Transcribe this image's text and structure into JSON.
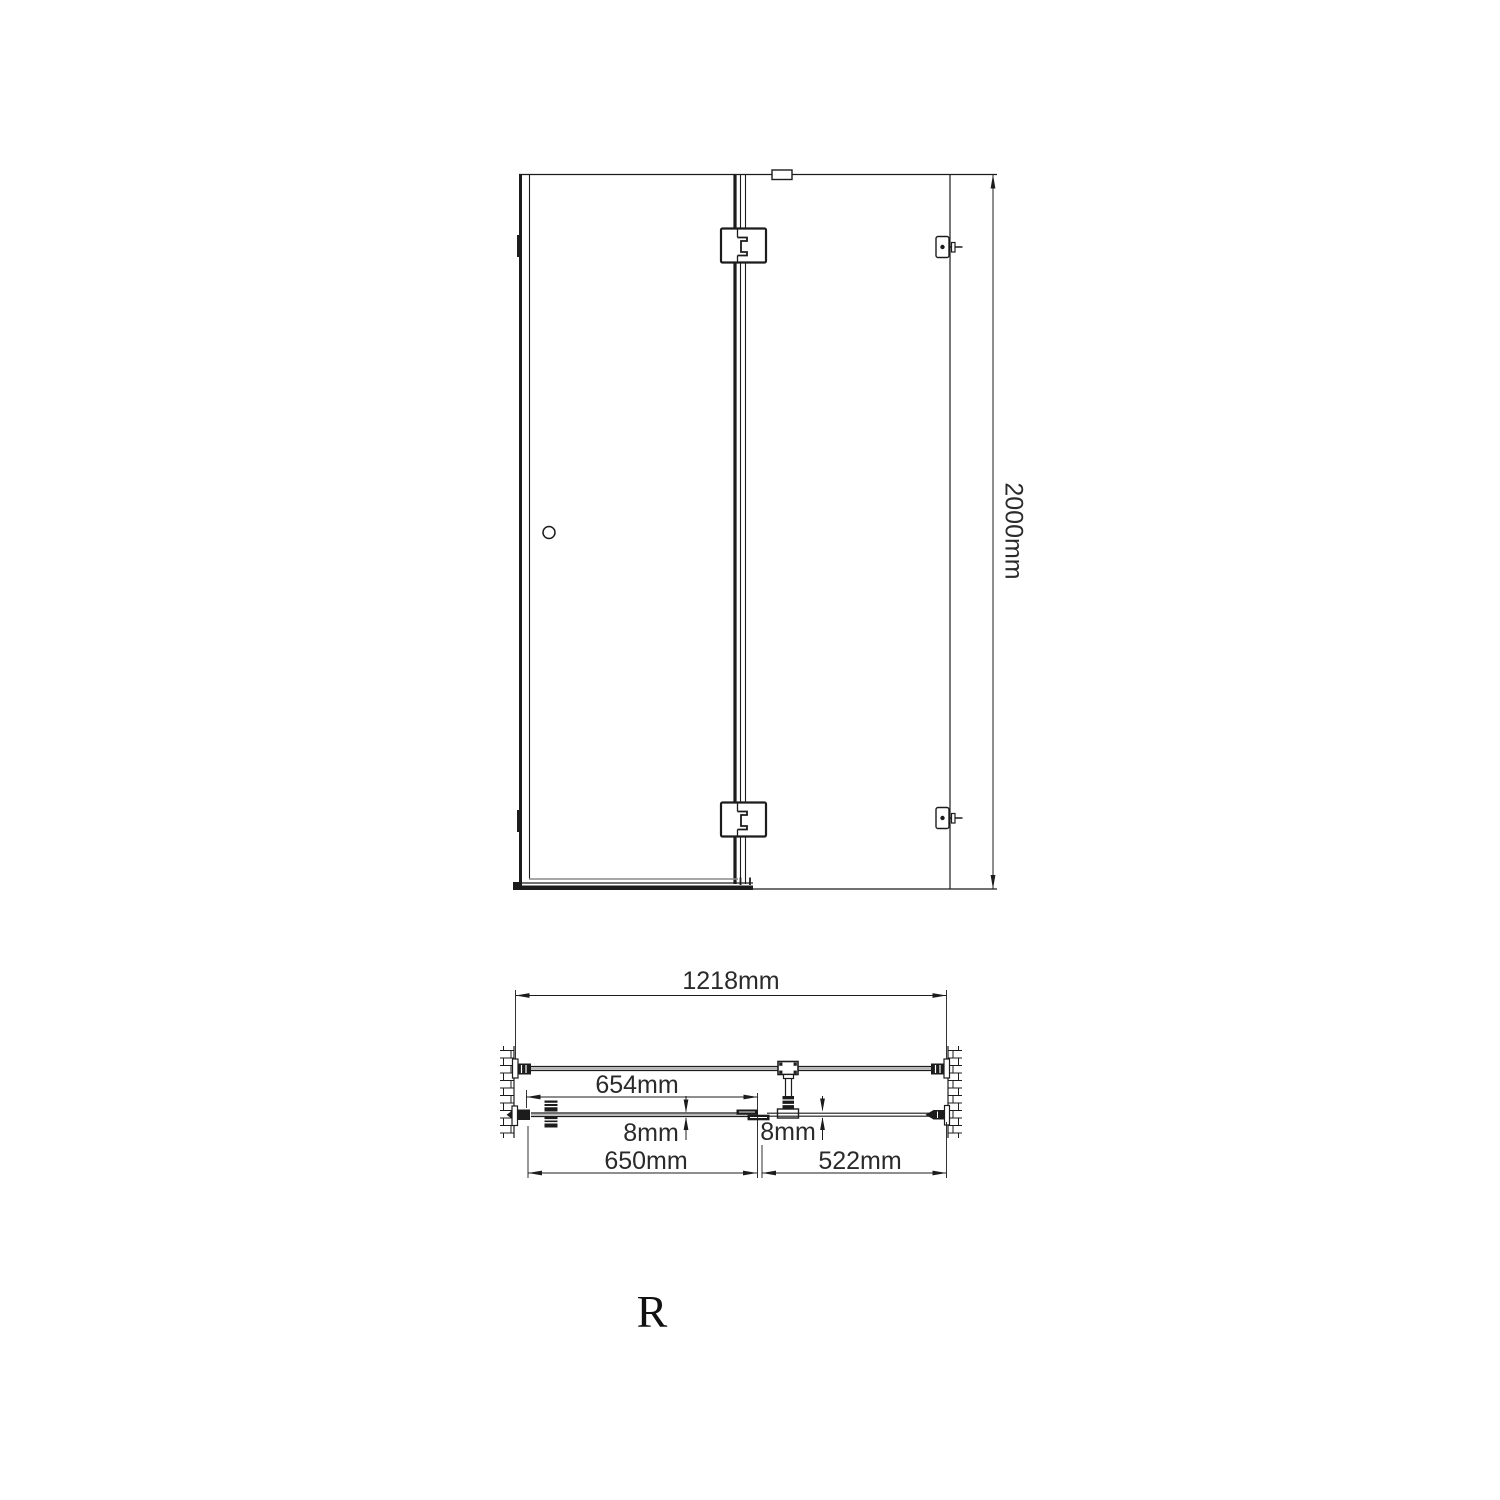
{
  "drawing": {
    "front_elevation": {
      "height_label": "2000mm"
    },
    "plan_view": {
      "overall_width_label": "1218mm",
      "glass_width_label": "654mm",
      "door_glass_thickness_label": "8mm",
      "panel_glass_thickness_label": "8mm",
      "door_width_label": "650mm",
      "side_panel_width_label": "522mm"
    },
    "handing_label": "R",
    "colors": {
      "line": "#1c1c1c",
      "light_line": "#8a8a8a",
      "background": "#ffffff"
    }
  }
}
